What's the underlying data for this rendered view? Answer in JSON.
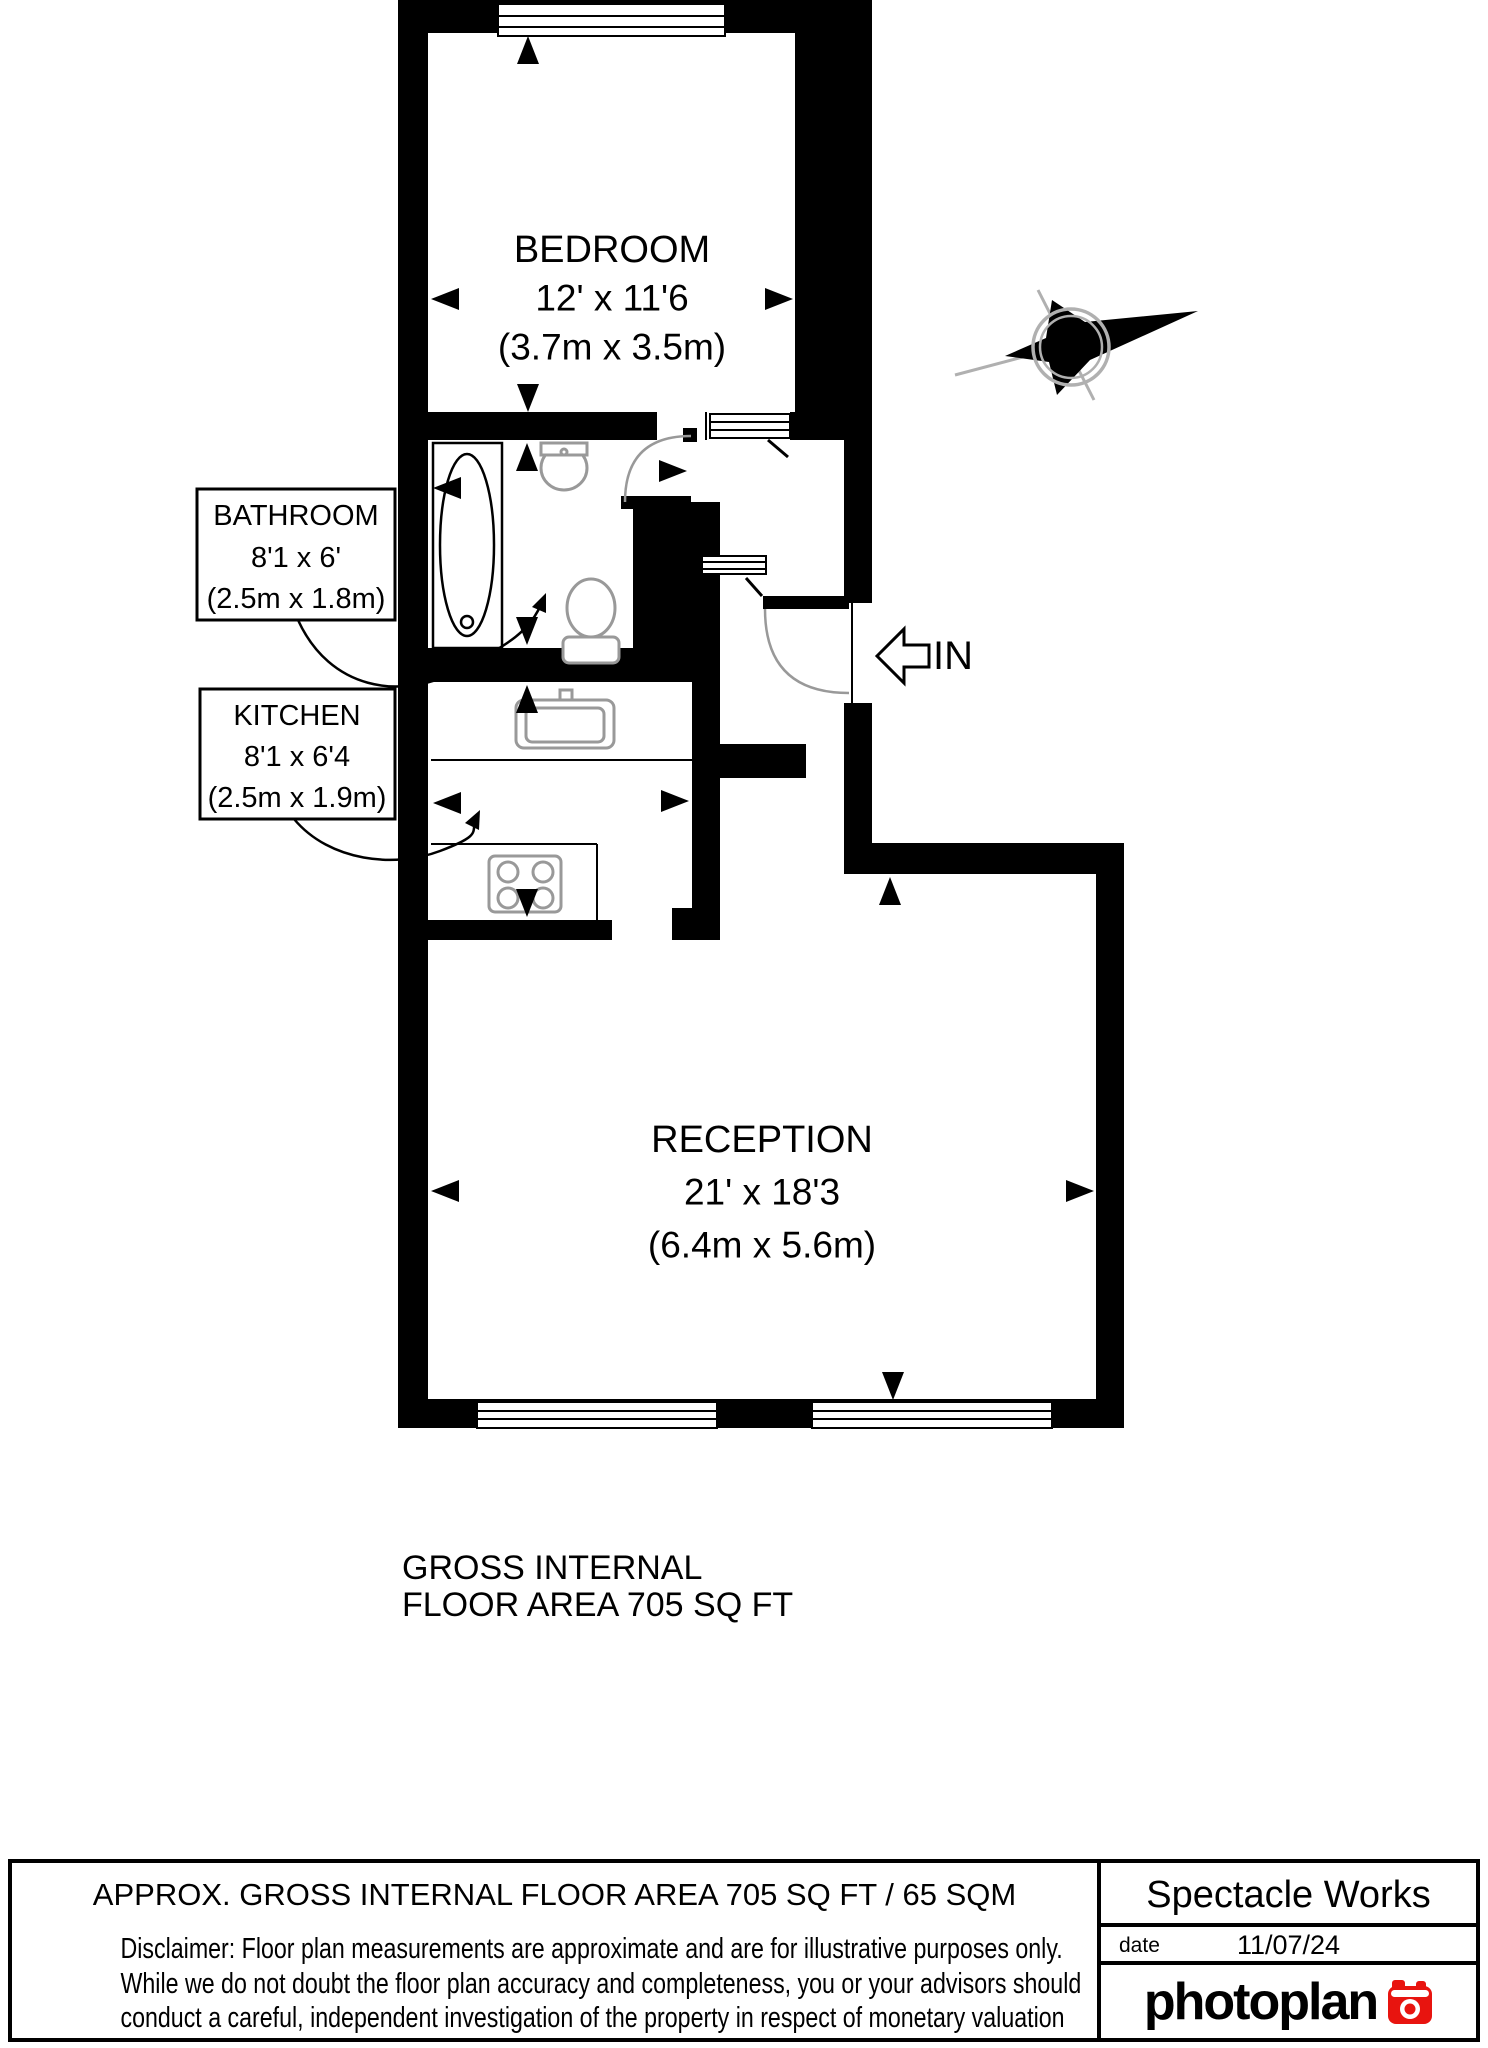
{
  "plan": {
    "rooms": {
      "bedroom": {
        "name": "BEDROOM",
        "dims_ft": "12' x 11'6",
        "dims_m": "(3.7m x 3.5m)"
      },
      "bathroom": {
        "name": "BATHROOM",
        "dims_ft": "8'1 x 6'",
        "dims_m": "(2.5m x 1.8m)"
      },
      "kitchen": {
        "name": "KITCHEN",
        "dims_ft": "8'1 x 6'4",
        "dims_m": "(2.5m x 1.9m)"
      },
      "reception": {
        "name": "RECEPTION",
        "dims_ft": "21' x 18'3",
        "dims_m": "(6.4m x 5.6m)"
      }
    },
    "entrance_label": "IN",
    "north_label": "N",
    "area_note_line1": "GROSS INTERNAL",
    "area_note_line2": "FLOOR AREA 705 SQ FT",
    "wall_color": "#000000",
    "fixture_color": "#999999",
    "compass_ring_color": "#b0b0b0"
  },
  "footer": {
    "area_summary": "APPROX. GROSS INTERNAL FLOOR AREA 705 SQ FT / 65 SQM",
    "disclaimer_line1": "Disclaimer: Floor plan measurements are approximate and are for illustrative purposes only.",
    "disclaimer_line2": "While we do not doubt the floor plan accuracy and completeness, you or your advisors should",
    "disclaimer_line3": "conduct a careful, independent investigation of the property in respect of monetary valuation",
    "company": "Spectacle Works",
    "date_label": "date",
    "date_value": "11/07/24",
    "brand": "photoplan",
    "brand_color": "#e8140f"
  }
}
